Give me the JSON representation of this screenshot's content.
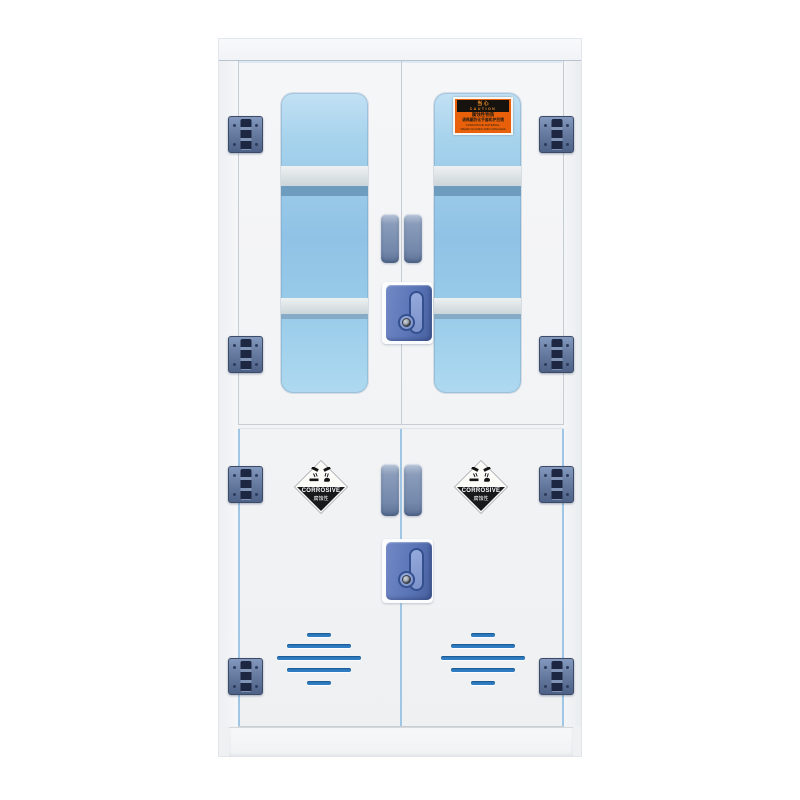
{
  "scene": {
    "description": "White laboratory safety storage cabinet for corrosive chemicals, glazed upper doors and solid vented lower doors",
    "background_color": "#ffffff"
  },
  "cabinet": {
    "body_color": "#f2f3f5",
    "glass_color": "#93c6e8",
    "hinge_color": "#66799f",
    "handle_color": "#7388ab",
    "lock_color": "#5a74b6",
    "vent_slot_color": "#2e7cc2",
    "hinge_count": 8,
    "door_count": 4,
    "vent_rows_per_door": 5
  },
  "labels": {
    "caution": {
      "bg_color": "#e8610a",
      "title_cn": "当 心",
      "title_en": "CAUTION",
      "line1": "腐蚀性物质",
      "line2": "请佩戴防化手套和护目镜",
      "line3": "CORROSIVE MATERIAL,",
      "line4": "WEAR GLOVES AND GOGGLES"
    },
    "hazard": {
      "text_en": "CORROSIVE",
      "text_cn": "腐蚀性"
    }
  }
}
